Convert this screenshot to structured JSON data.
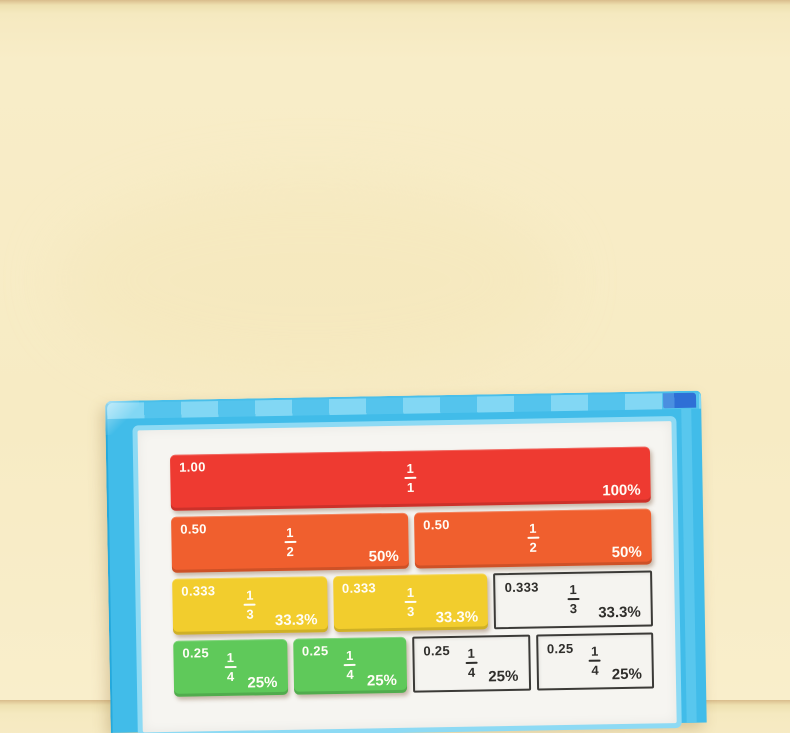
{
  "scene": {
    "subject": "Magnetic fraction tiles learning board on a cream backdrop",
    "background_color": "#f8edc8",
    "board_frame_color": "#41bce9",
    "board_corner_patch_color": "#2e6fd6",
    "page_color": "#f6f5f1"
  },
  "tile_colors": {
    "whole": "#ee3a31",
    "halves": "#f05f2e",
    "thirds": "#f2cd2d",
    "quarters": "#5fc95a"
  },
  "fraction_rows": [
    {
      "name": "whole",
      "cells": [
        {
          "kind": "tile",
          "decimal": "1.00",
          "numerator": "1",
          "denominator": "1",
          "percent": "100%"
        }
      ]
    },
    {
      "name": "halves",
      "cells": [
        {
          "kind": "tile",
          "decimal": "0.50",
          "numerator": "1",
          "denominator": "2",
          "percent": "50%"
        },
        {
          "kind": "tile",
          "decimal": "0.50",
          "numerator": "1",
          "denominator": "2",
          "percent": "50%"
        }
      ]
    },
    {
      "name": "thirds",
      "cells": [
        {
          "kind": "tile",
          "decimal": "0.333",
          "numerator": "1",
          "denominator": "3",
          "percent": "33.3%"
        },
        {
          "kind": "tile",
          "decimal": "0.333",
          "numerator": "1",
          "denominator": "3",
          "percent": "33.3%"
        },
        {
          "kind": "printed",
          "decimal": "0.333",
          "numerator": "1",
          "denominator": "3",
          "percent": "33.3%"
        }
      ]
    },
    {
      "name": "quarters",
      "cells": [
        {
          "kind": "tile",
          "decimal": "0.25",
          "numerator": "1",
          "denominator": "4",
          "percent": "25%"
        },
        {
          "kind": "tile",
          "decimal": "0.25",
          "numerator": "1",
          "denominator": "4",
          "percent": "25%"
        },
        {
          "kind": "printed",
          "decimal": "0.25",
          "numerator": "1",
          "denominator": "4",
          "percent": "25%"
        },
        {
          "kind": "printed",
          "decimal": "0.25",
          "numerator": "1",
          "denominator": "4",
          "percent": "25%"
        }
      ]
    }
  ]
}
